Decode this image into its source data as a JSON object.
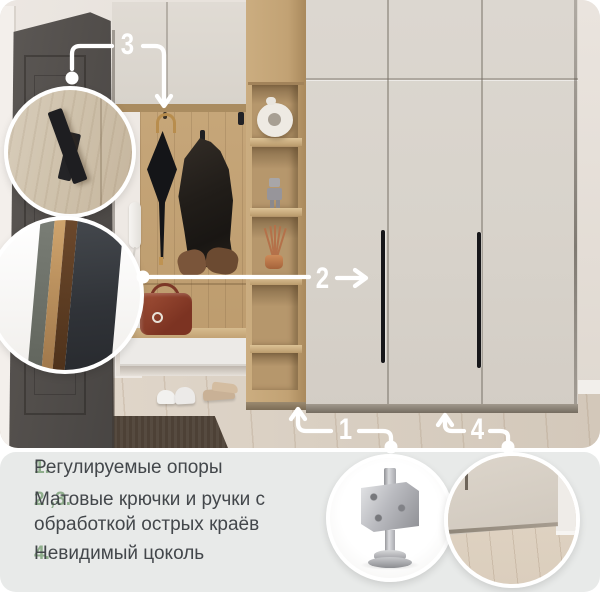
{
  "colors": {
    "annotation": "#ffffff",
    "accent_green": "#8fae8c",
    "panel_bg": "#e8eae9",
    "text": "#43474b"
  },
  "callouts": {
    "c1": "1",
    "c2": "2",
    "c3": "3",
    "c4": "4"
  },
  "features": [
    {
      "num": "1.",
      "text": "Регулируемые опоры"
    },
    {
      "num": "2 ,3.",
      "text": "Матовые крючки и ручки с обработкой острых краёв"
    },
    {
      "num": "4.",
      "text": "Невидимый цоколь"
    }
  ],
  "insets": {
    "hook": "matte-hook-closeup",
    "edge": "handle-edge-closeup",
    "caster": "adjustable-foot-closeup",
    "plinth": "hidden-plinth-closeup"
  }
}
